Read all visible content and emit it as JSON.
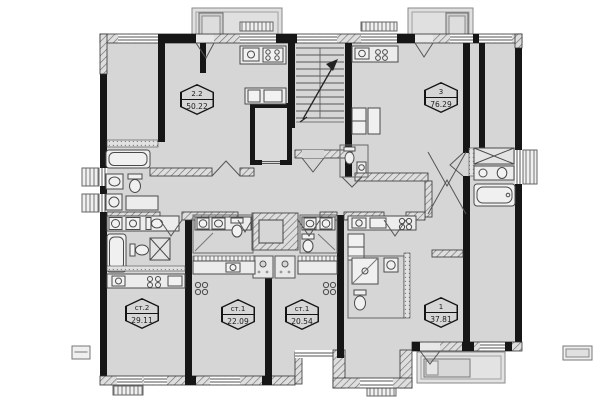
{
  "plan": {
    "floor_color": "#d6d6d6",
    "wall_color": "#1a1a1a",
    "units": [
      {
        "name": "2.2",
        "area": "50.22"
      },
      {
        "name": "3",
        "area": "76.29"
      },
      {
        "name": "ст.2",
        "area": "29.11"
      },
      {
        "name": "ст.1",
        "area": "22.09"
      },
      {
        "name": "ст.1",
        "area": "20.54"
      },
      {
        "name": "1",
        "area": "37.81"
      }
    ],
    "icons": {
      "stairs-icon": "parallel treads with diagonal up arrow",
      "elevator-shaft-icon": "thick-wall rectangle",
      "bathtub-icon": "rounded rectangle tub",
      "toilet-icon": "tank and oval bowl",
      "sink-icon": "basin with circle",
      "stove-icon": "four burner circles",
      "washer-icon": "square with drum circle",
      "wardrobe-icon": "rectangle with X cross",
      "door-icon": "V swing lines",
      "window-icon": "double line gap in wall",
      "balcony-icon": "thin double outline"
    }
  }
}
